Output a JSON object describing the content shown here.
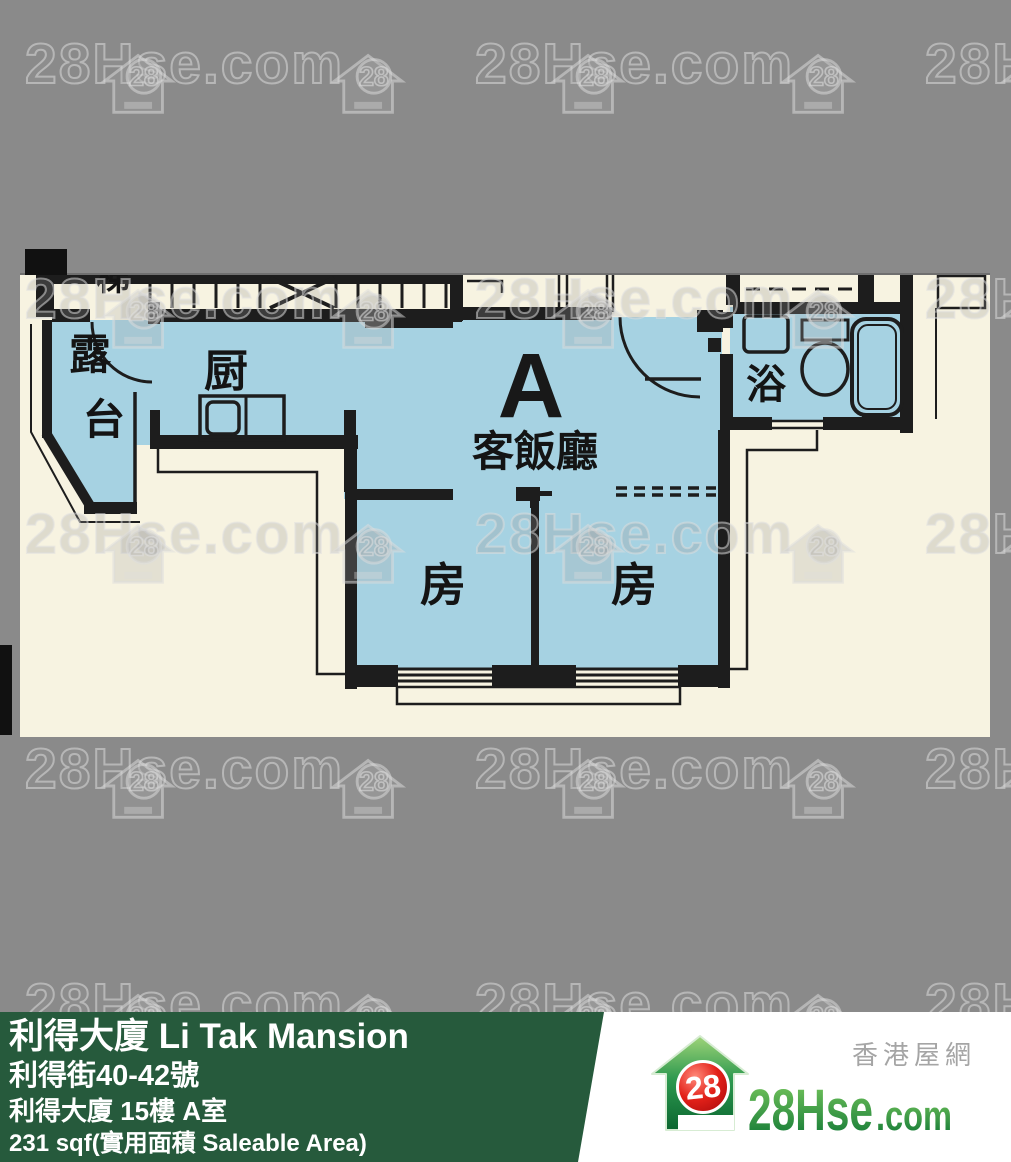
{
  "watermark": {
    "brand": "28Hse.com",
    "badge": "28"
  },
  "floor_plan": {
    "unit_label": "A",
    "stairs_label": "梯",
    "rooms": {
      "balcony_char1": "露",
      "balcony_char2": "台",
      "kitchen": "厨",
      "living_dining": "客飯廳",
      "bath": "浴",
      "bedroom_left": "房",
      "bedroom_right": "房"
    }
  },
  "info_bar": {
    "title": "利得大廈 Li Tak Mansion",
    "address": "利得街40-42號",
    "unit": "利得大廈 15樓 A室",
    "area": "231 sqf(實用面積 Saleable Area)"
  },
  "logo": {
    "badge": "28",
    "brand_main": "28Hse",
    "brand_suffix": ".com",
    "tagline": "香港屋網"
  },
  "colors": {
    "bg": "#8a8a8a",
    "cream": "#f7f3e1",
    "blue": "#a6d2e2",
    "wall": "#1d1d1d",
    "band": "#265a3c",
    "white": "#ffffff",
    "logo_red": "#d42020",
    "logo_green": "#0c7434",
    "tagline_gray": "#a5a5a5"
  }
}
